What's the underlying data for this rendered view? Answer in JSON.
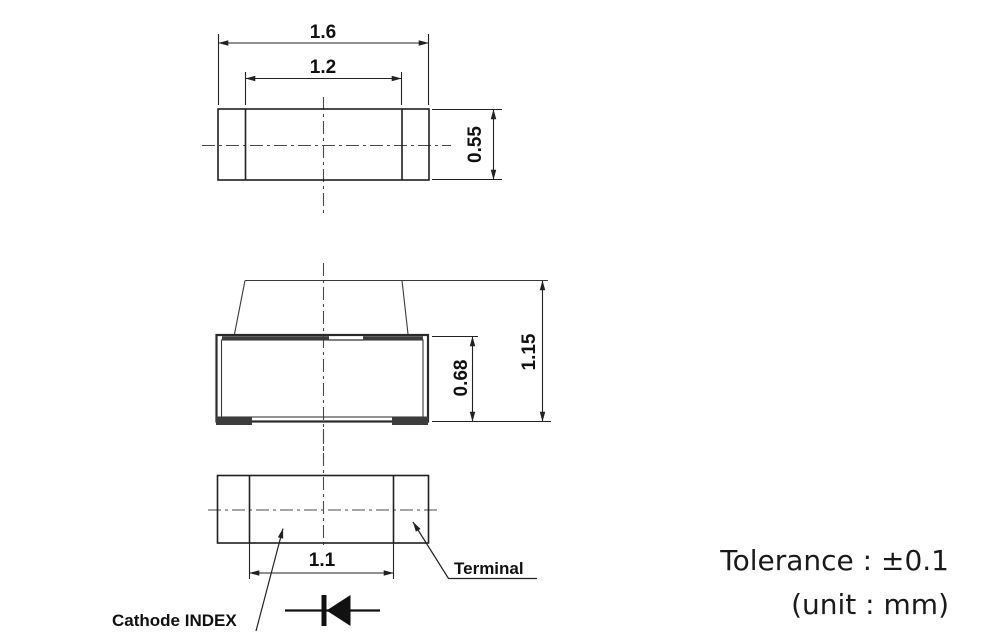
{
  "drawing": {
    "type": "mechanical-dimension-drawing",
    "subject": "SMD chip LED package (top / side / bottom views)",
    "dimensions": {
      "overall_width": "1.6",
      "resin_width": "1.2",
      "top_view_depth": "0.55",
      "body_height": "0.68",
      "overall_height": "1.15",
      "terminal_span": "1.1"
    },
    "labels": {
      "terminal": "Terminal",
      "cathode_index": "Cathode INDEX"
    },
    "notes": {
      "tolerance": "Tolerance : ±0.1",
      "unit": "(unit : mm)"
    },
    "colors": {
      "background": "#ffffff",
      "line": "#1f1f1f",
      "centerline": "#4a4a4a",
      "text": "#111111",
      "note_text": "#1a1a1a"
    }
  }
}
